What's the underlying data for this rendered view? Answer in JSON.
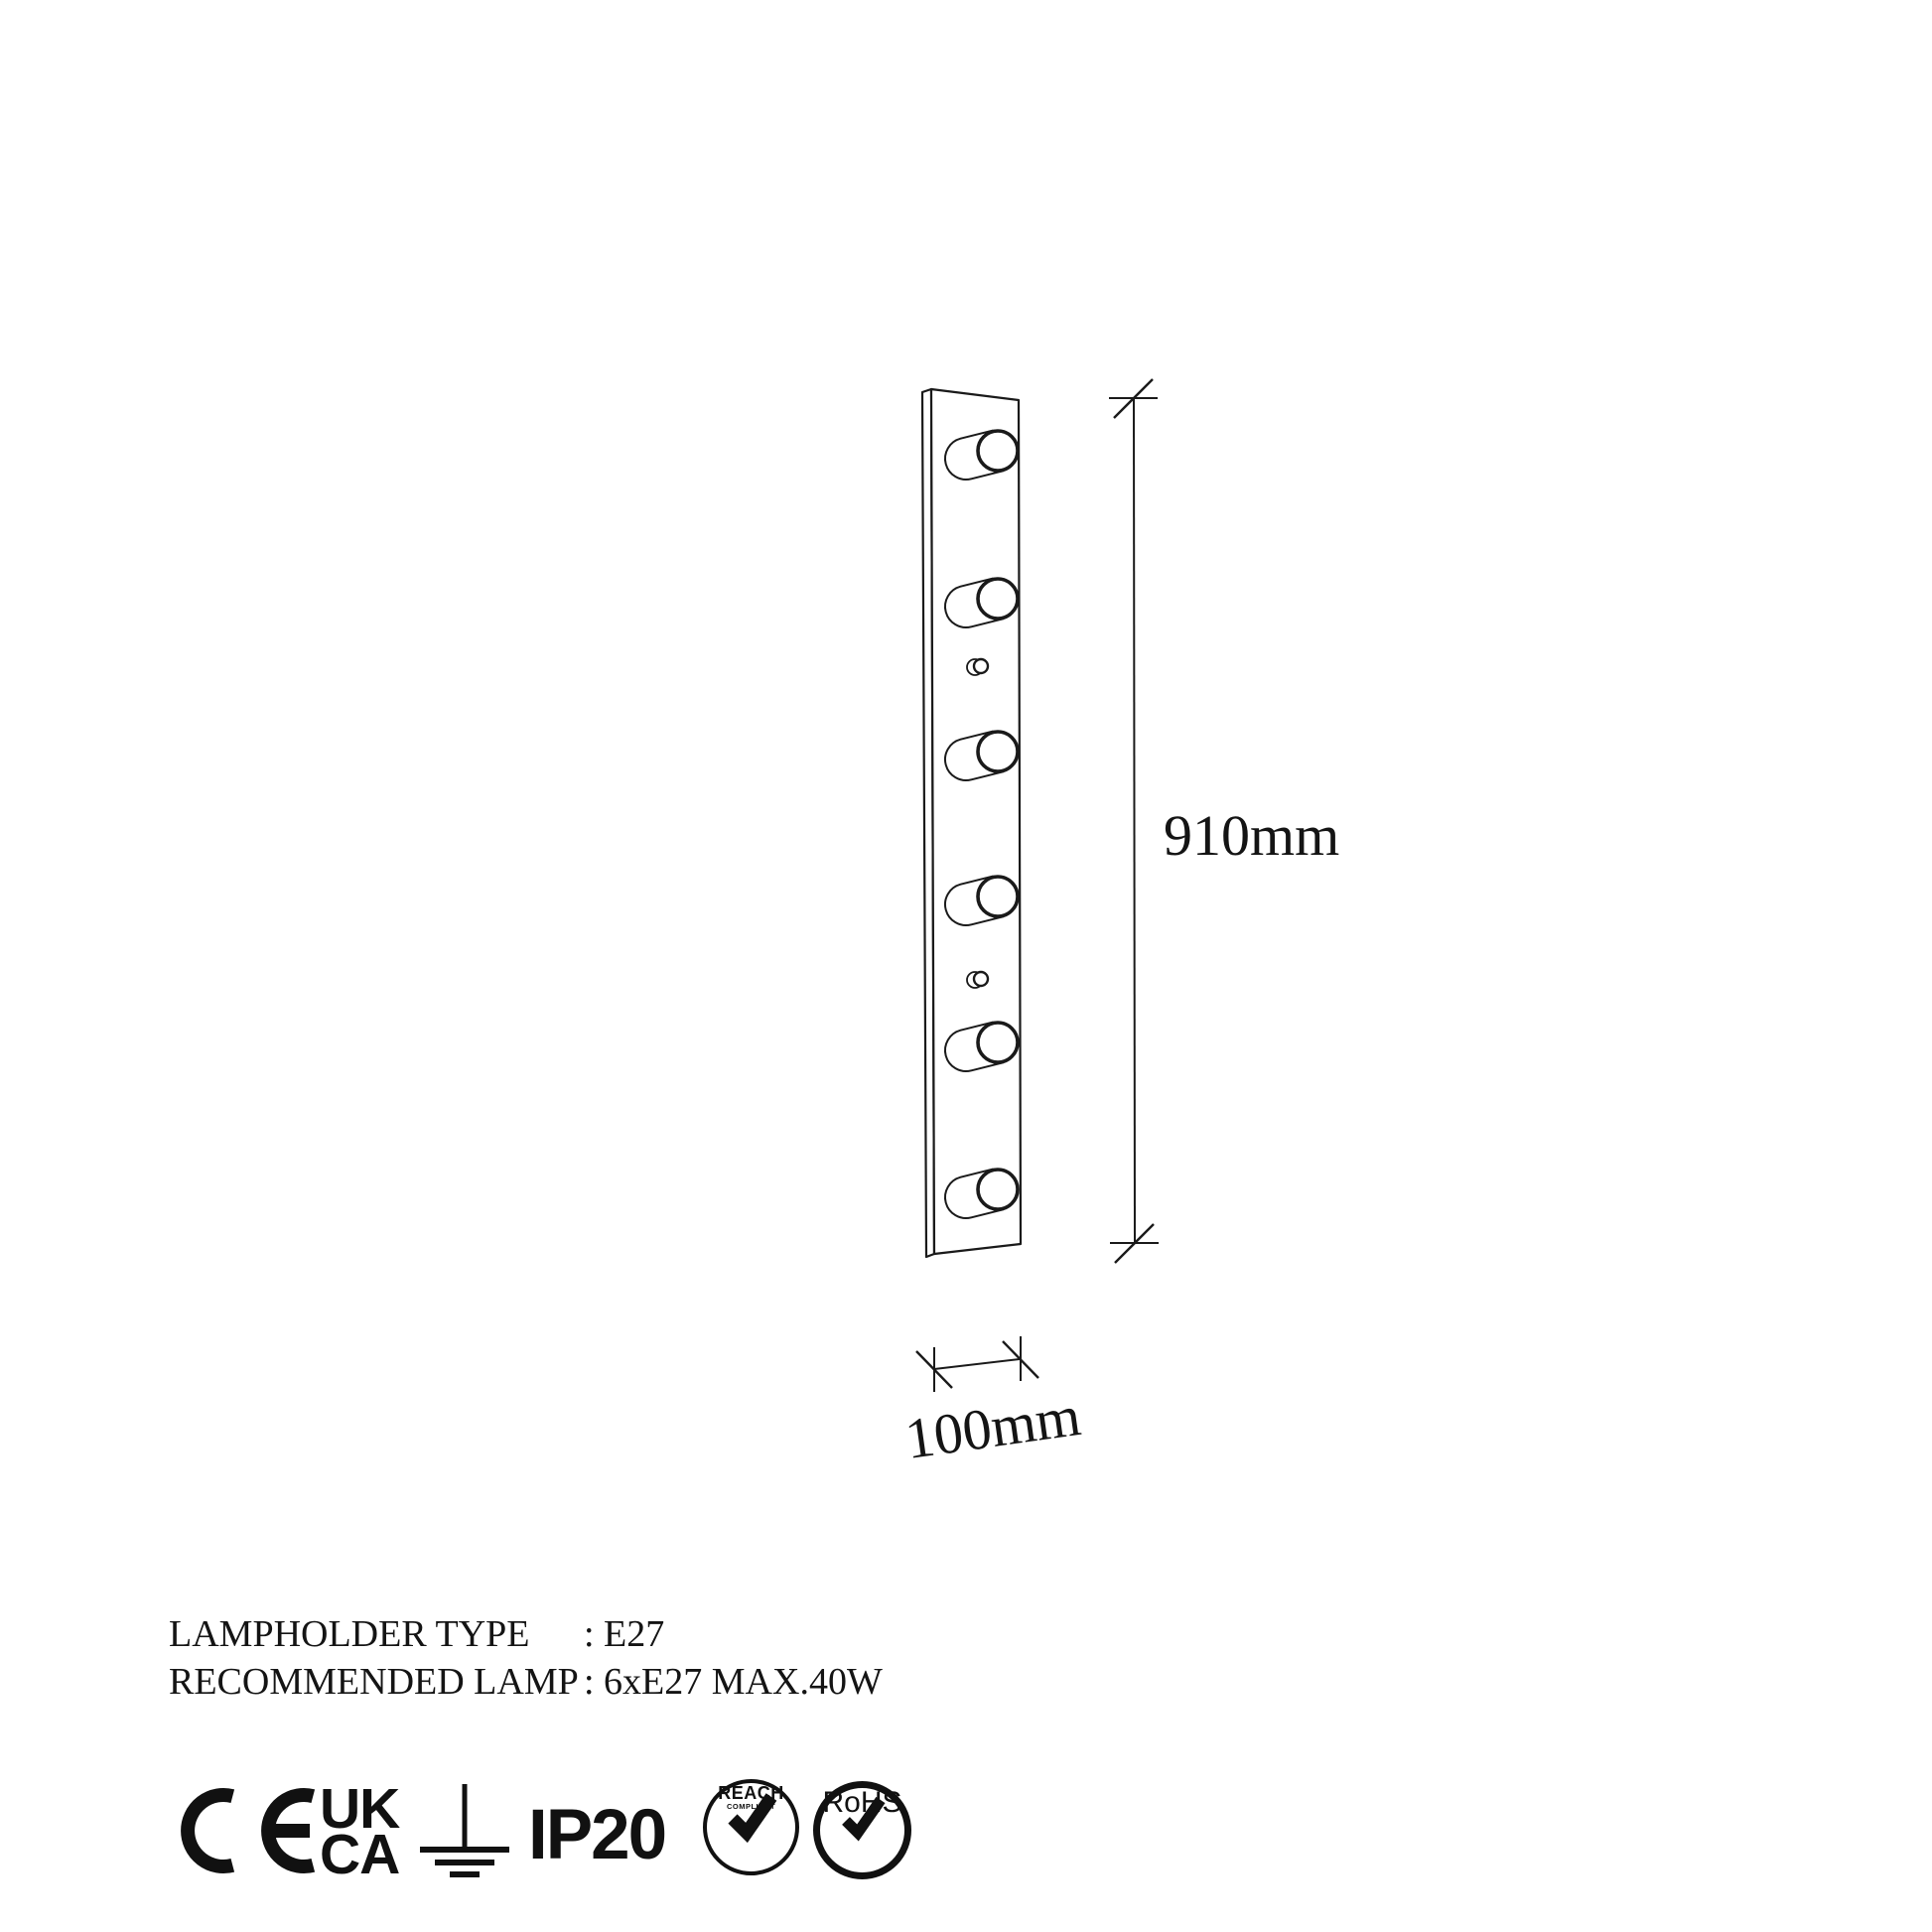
{
  "drawing": {
    "description": "wall lamp 6-bulb vanity bar technical drawing",
    "height_label": "910mm",
    "width_label": "100mm",
    "lamp_count": 6,
    "lamp_centers_y": [
      454,
      603,
      757,
      903,
      1050,
      1198
    ],
    "knob_centers_y": [
      671,
      986
    ]
  },
  "specs": {
    "rows": [
      {
        "label": "LAMPHOLDER TYPE",
        "value": ": E27"
      },
      {
        "label": "RECOMMENDED LAMP",
        "value": ": 6xE27 MAX.40W"
      }
    ]
  },
  "certifications": {
    "ukca_top": "UK",
    "ukca_bottom": "CA",
    "ip_rating": "IP20",
    "reach_label": "REACH",
    "reach_sublabel": "COMPLIANT",
    "rohs_label": "RoHS"
  },
  "colors": {
    "line": "#1a1a1a",
    "background": "#ffffff"
  }
}
